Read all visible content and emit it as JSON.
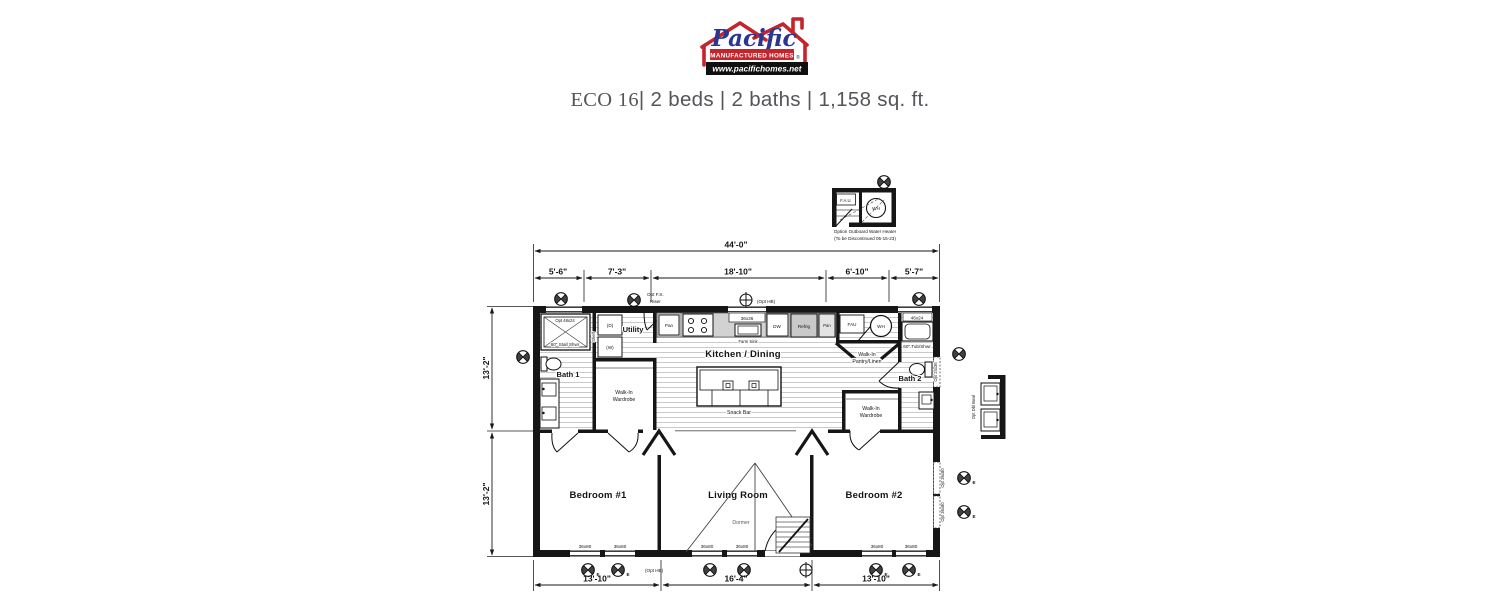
{
  "logo": {
    "brand": "Pacific",
    "tagline": "MANUFACTURED HOMES",
    "website": "www.pacifichomes.net",
    "reg": "®",
    "colors": {
      "red": "#c4242b",
      "blue": "#2b3691",
      "black": "#111111"
    }
  },
  "title": {
    "model": "ECO 16",
    "specs": "| 2 beds | 2 baths | 1,158 sq. ft."
  },
  "detail_water_heater": {
    "fau": "F.A.U.",
    "wh": "WH",
    "caption1": "Option Outboard Water Heater",
    "caption2": "(To be Discontinued 05-15-23)"
  },
  "detail_vanity": {
    "caption": "Opt Dbl Bowl"
  },
  "dimensions": {
    "overall_width": "44'-0\"",
    "top": [
      "5'-6\"",
      "7'-3\"",
      "18'-10\"",
      "6'-10\"",
      "5'-7\""
    ],
    "left": [
      "13'-2\"",
      "13'-2\""
    ],
    "bottom": [
      "13'-10\"",
      "16'-4\"",
      "13'-10\""
    ]
  },
  "rooms": {
    "bath1": "Bath 1",
    "utility": "Utility",
    "kitchen": "Kitchen / Dining",
    "bath2": "Bath 2",
    "bedroom1": "Bedroom #1",
    "living": "Living Room",
    "bedroom2": "Bedroom #2",
    "walkin1": "Walk-In",
    "walkin2": "Wardrobe",
    "pantry1": "Walk-In",
    "pantry2": "Pantry/Linen",
    "dormer": "Dormer"
  },
  "fixtures": {
    "opt_win_48x24": "Opt 48x24",
    "stall_shwr": "60\" Stall Shwr",
    "dryer": "(D)",
    "washer": "(W)",
    "shelf": "Shelf",
    "opt_fs1": "Opt F.S.",
    "opt_fs2": "Riser",
    "pan": "Pan",
    "win_36x36": "36x36",
    "farm_sink": "Farm Sink",
    "dw": "DW",
    "refrig": "Refrig",
    "fau": "FAU",
    "wh": "WH",
    "opt_hb": "(Opt HB)",
    "win_46x24": "46x24",
    "tub_shwr": "60\" Tub/Shwr",
    "opt_win_24x36": "Opt 24x36",
    "snack_bar": "Snack Bar",
    "win_36x80": "36x80",
    "opt_win_36x80": "Opt 36x80",
    "egress": "E"
  }
}
